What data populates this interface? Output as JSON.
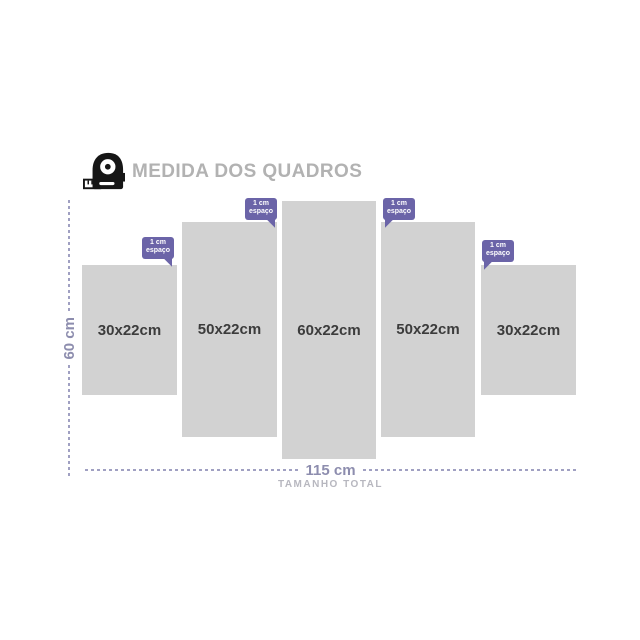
{
  "title": "MEDIDA DOS QUADROS",
  "panels": [
    {
      "label": "30x22cm"
    },
    {
      "label": "50x22cm"
    },
    {
      "label": "60x22cm"
    },
    {
      "label": "50x22cm"
    },
    {
      "label": "30x22cm"
    }
  ],
  "spacing_badges": [
    {
      "line1": "1 cm",
      "line2": "espaço"
    },
    {
      "line1": "1 cm",
      "line2": "espaço"
    },
    {
      "line1": "1 cm",
      "line2": "espaço"
    },
    {
      "line1": "1 cm",
      "line2": "espaço"
    }
  ],
  "dimensions": {
    "height_label": "60 cm",
    "width_label": "115 cm",
    "total_caption": "TAMANHO TOTAL"
  },
  "colors": {
    "badge": "#6b64a8",
    "panel": "#d2d2d2",
    "panel_text": "#3c3c3c",
    "dim_text": "#8d8dae",
    "dash": "#a0a0c2",
    "title": "#b2b2b2",
    "muted": "#b7b7bf",
    "icon": "#161616"
  }
}
